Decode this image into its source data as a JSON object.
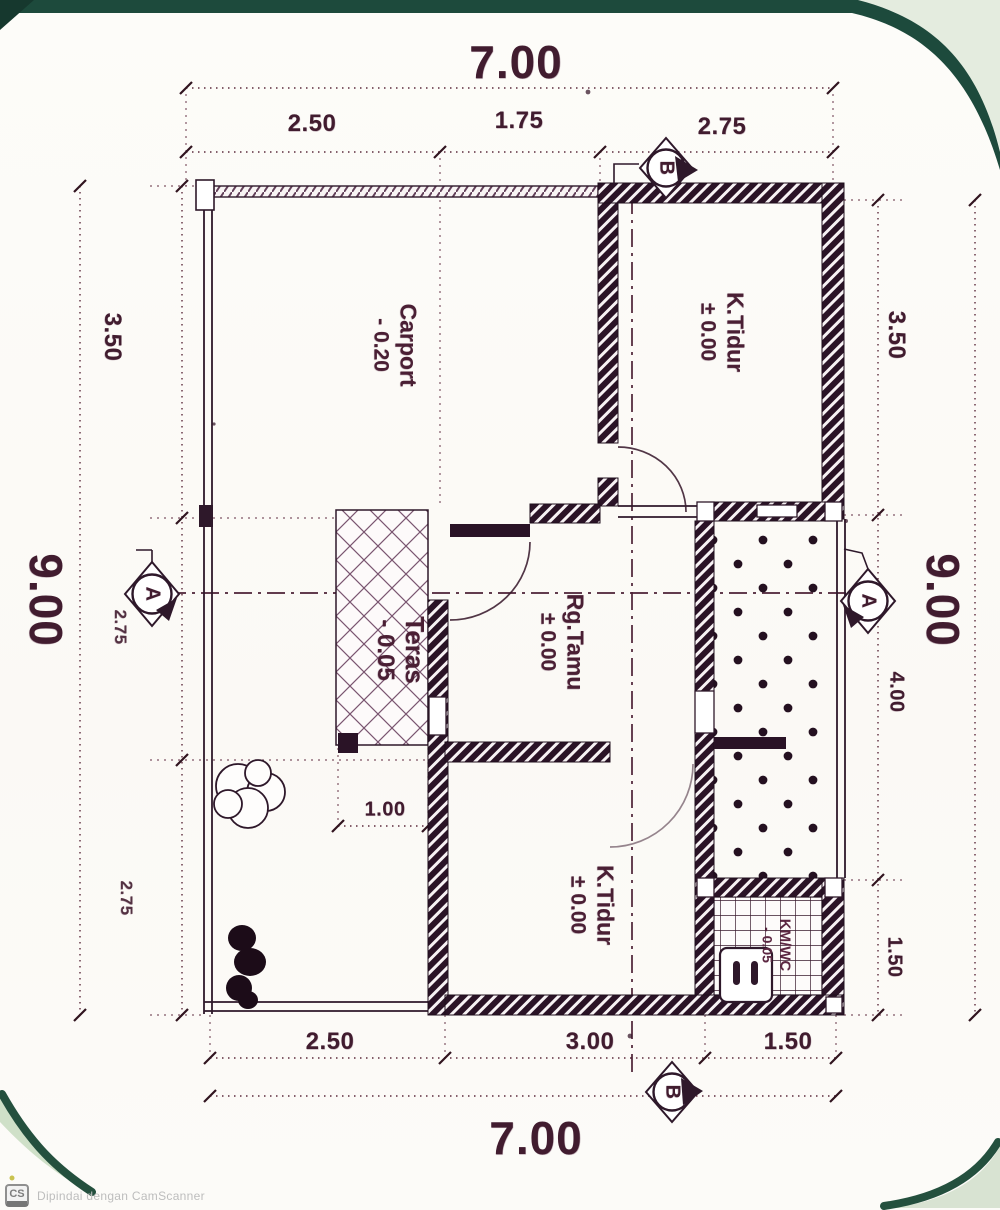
{
  "dims": {
    "top": {
      "main": "7.00",
      "segments": [
        "2.50",
        "1.75",
        "2.75"
      ]
    },
    "bottom": {
      "main": "7.00",
      "segments": [
        "2.50",
        "3.00",
        "1.50"
      ]
    },
    "left": {
      "main": "9.00",
      "segments": [
        "3.50",
        "2.75",
        "2.75"
      ]
    },
    "right": {
      "main": "9.00",
      "segments": [
        "3.50",
        "4.00",
        "1.50"
      ]
    },
    "teras_width": "1.00"
  },
  "rooms": {
    "carport": {
      "name": "Carport",
      "level": "- 0.20"
    },
    "bedroom_top": {
      "name": "K.Tidur",
      "level": "± 0.00"
    },
    "teras": {
      "name": "Teras",
      "level": "- 0.05"
    },
    "living": {
      "name": "Rg.Tamu",
      "level": "± 0.00"
    },
    "bedroom_bottom": {
      "name": "K.Tidur",
      "level": "± 0.00"
    },
    "bathroom": {
      "name": "KM/WC",
      "level": "- 0.05"
    }
  },
  "markers": {
    "a": "A",
    "b": "B"
  },
  "watermark": {
    "badge": "CS",
    "text": "Dipindai dengan CamScanner"
  },
  "colors": {
    "ink": "#2e182a",
    "wall_fill": "#271224",
    "green_dark": "#1d4a3c",
    "green_pale": "#e4ecdf",
    "watermark_gray": "#bdbdbd"
  }
}
